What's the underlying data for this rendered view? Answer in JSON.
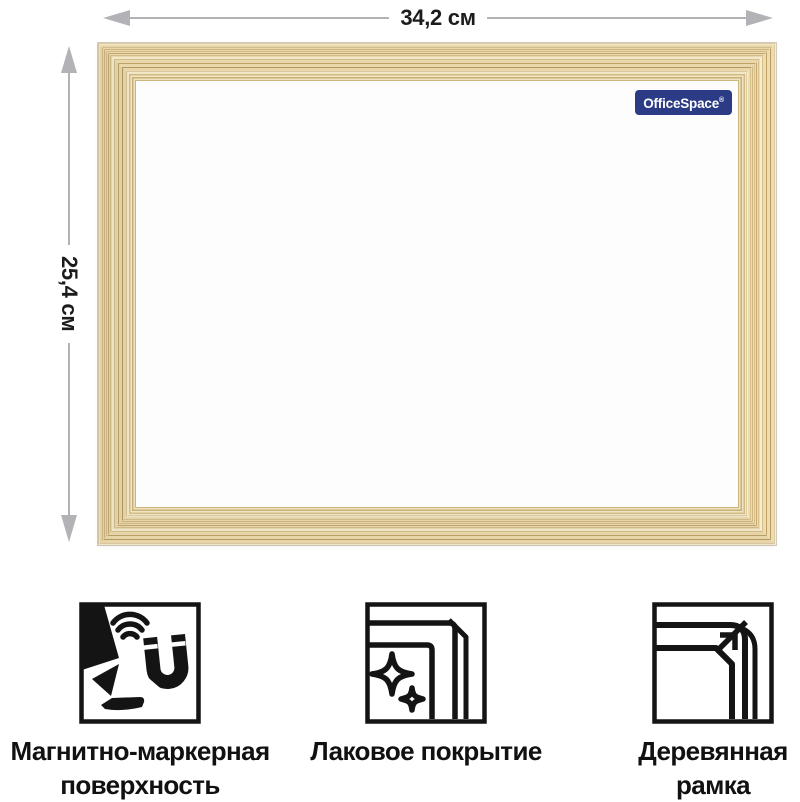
{
  "dimensions": {
    "width": {
      "label": "34,2 см"
    },
    "height": {
      "label": "25,4 см"
    }
  },
  "board": {
    "brand": {
      "name": "OfficeSpace",
      "registered_mark": "®"
    }
  },
  "features": [
    {
      "icon": "marker-magnet-icon",
      "lines": [
        "Магнитно-маркерная",
        "поверхность"
      ]
    },
    {
      "icon": "sparkle-corner-icon",
      "lines": [
        "Лаковое покрытие"
      ]
    },
    {
      "icon": "wood-corner-icon",
      "lines": [
        "Деревянная",
        "рамка"
      ]
    }
  ],
  "colors": {
    "wood_base": "#e8d8ab",
    "wood_dark": "#cdb27c",
    "wood_light": "#f3e9ca",
    "surface": "#fdfdfd",
    "arrow": "#b2b2b7",
    "dimension_text": "#1c1c1e",
    "icon_stroke": "#141414",
    "brand_bg": "#2b3b85",
    "brand_text": "#ffffff"
  }
}
